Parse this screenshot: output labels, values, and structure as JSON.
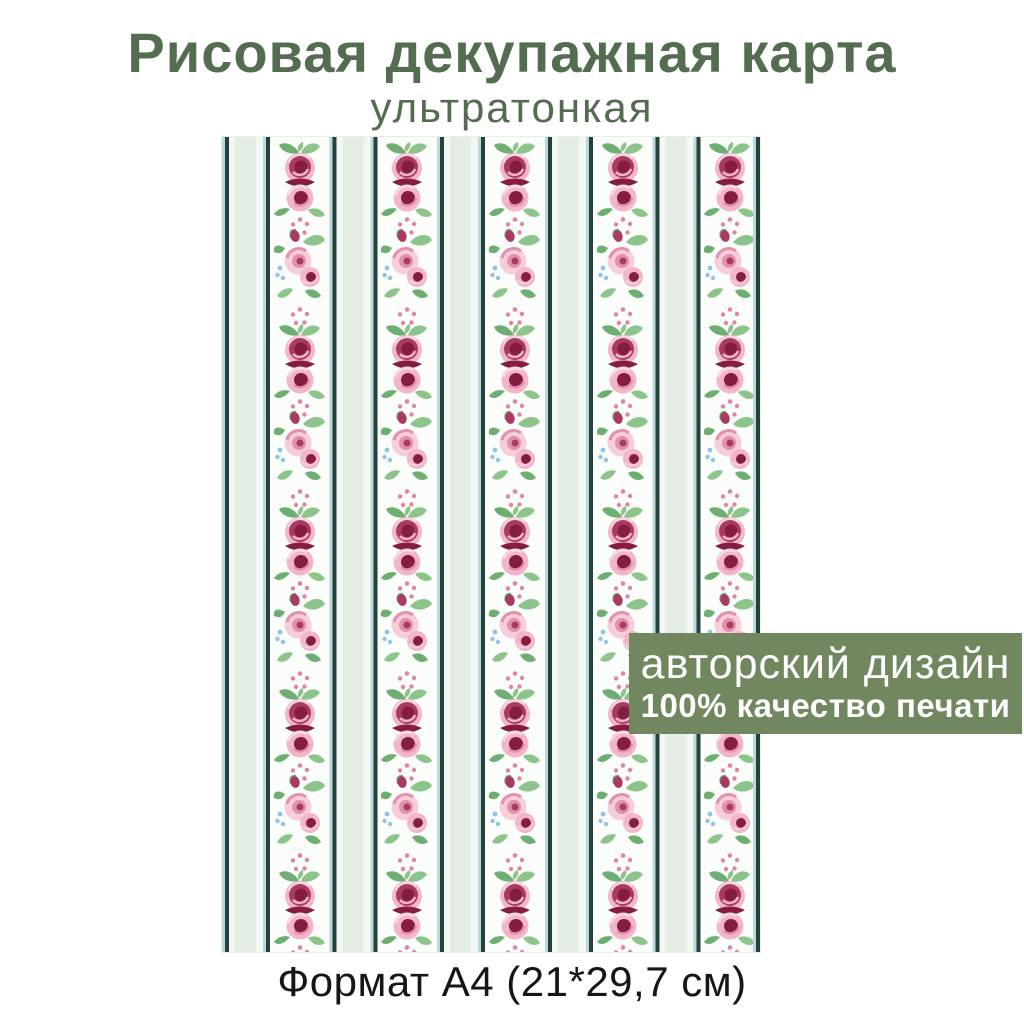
{
  "header": {
    "title": "Рисовая декупажная карта",
    "subtitle": "ультратонкая"
  },
  "badge": {
    "line1": "авторский дизайн",
    "line2": "100% качество печати"
  },
  "footer": {
    "format_text": "Формат А4 (21*29,7 см)"
  },
  "palette": {
    "title-green": "#546c50",
    "badge-green": "#71875f",
    "text-dark": "#161616",
    "paper-band": "#fbfdfa",
    "stripe-dark": "#24413a",
    "stripe-blue": "#bcd7dd",
    "stripe-mint": "#e3ede4",
    "stripe-white": "#f4f8f3",
    "leaf-light": "#8cc48b",
    "leaf-dark": "#6fae72",
    "rose-pink": "#f2b6c8",
    "rose-pale": "#f7cdd9",
    "rose-mid": "#e190ae",
    "rose-wine": "#851d41",
    "rose-wine-light": "#a93b60",
    "rose-pink-pale": "#f9d8e1",
    "dot-pink": "#e283a2",
    "dot-blue": "#8fc3e8"
  },
  "paper": {
    "description": "A4 sheet preview with vertical stripe and rose-column wallpaper pattern",
    "pattern": {
      "columns": 5,
      "column_start_x": 77.8,
      "column_spacing": 107.6,
      "column_height": 815,
      "cycle_height": 182,
      "cycles": 5,
      "motifs": [
        {
          "type": "rose-large",
          "offset": 43,
          "width": 56,
          "height": 78
        },
        {
          "type": "dots",
          "offset": 90,
          "width": 22,
          "height": 22
        },
        {
          "type": "rose-light",
          "offset": 127,
          "width": 54,
          "height": 72
        },
        {
          "type": "dots",
          "offset": 180,
          "width": 22,
          "height": 22
        }
      ]
    }
  }
}
